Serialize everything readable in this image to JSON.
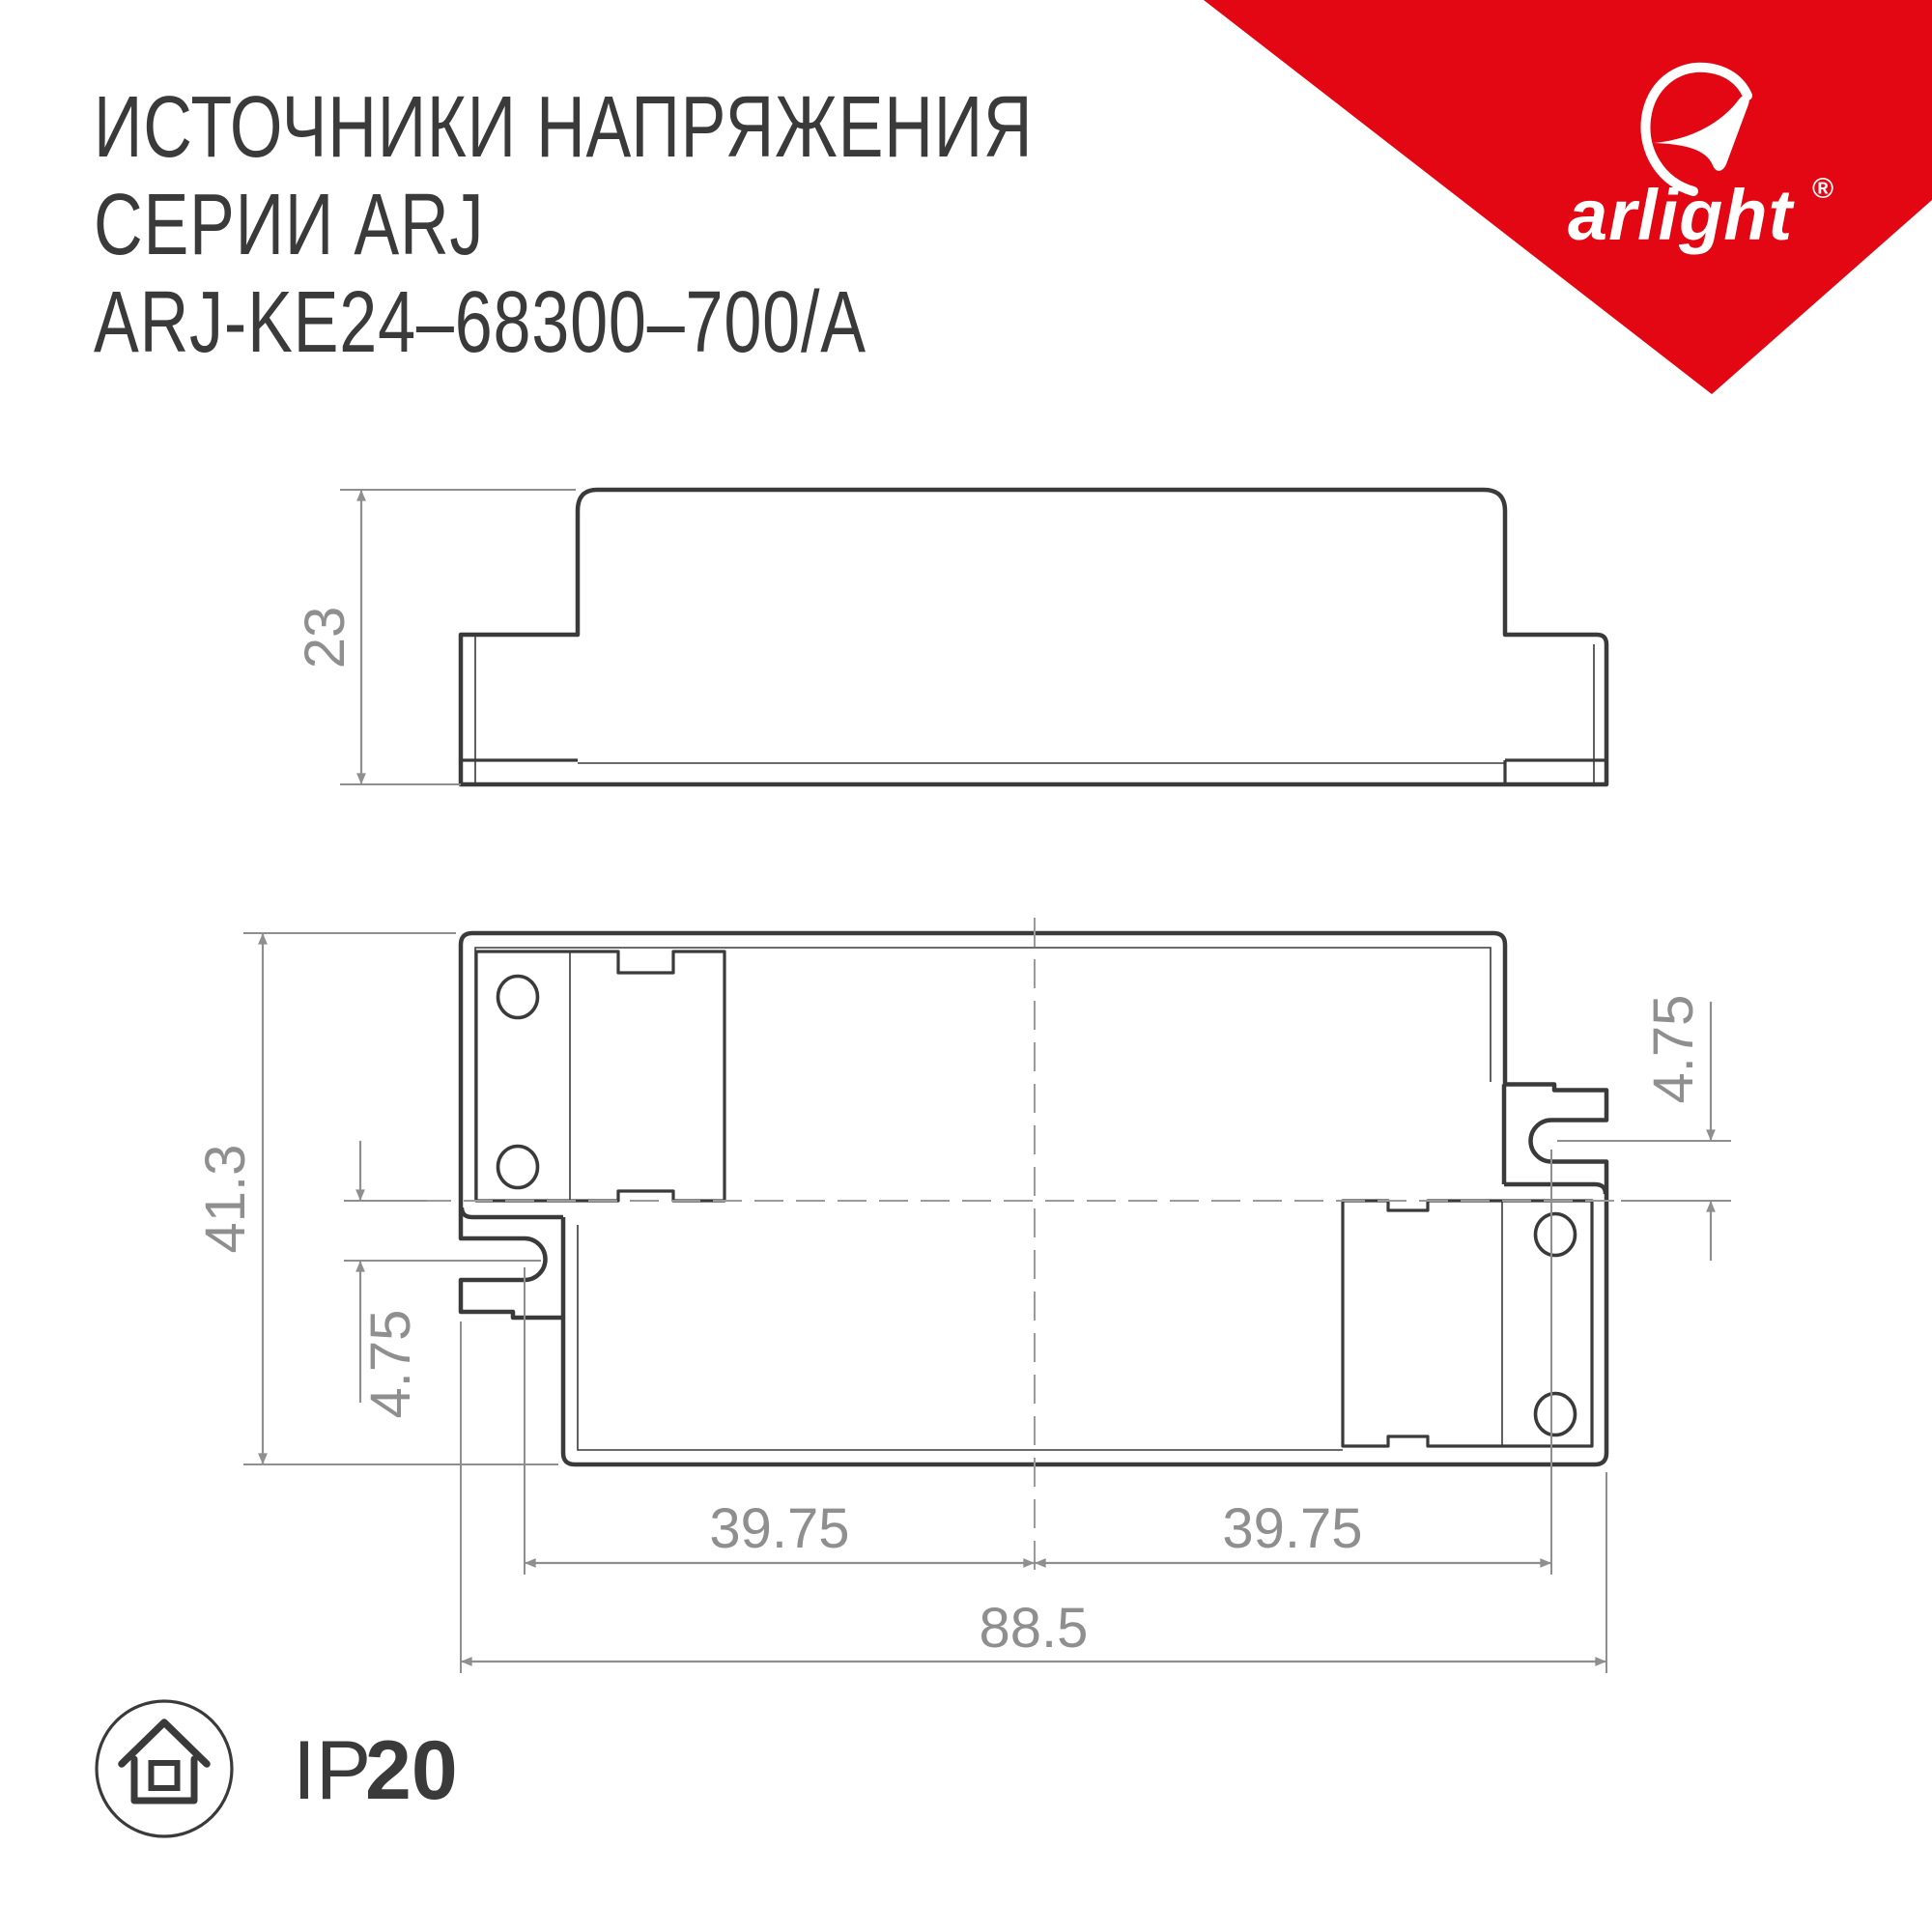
{
  "title": {
    "line1": "ИСТОЧНИКИ НАПРЯЖЕНИЯ",
    "line2": "СЕРИИ ARJ",
    "line3": "ARJ-KE24–68300–700/A"
  },
  "brand": {
    "wordmark": "arlight",
    "registered": "®",
    "triangle_color": "#e30613"
  },
  "drawing": {
    "views": {
      "side_view": "side profile of enclosure",
      "top_view": "plan view of enclosure with mounting tabs"
    },
    "dimensions": {
      "side_height": "23",
      "top_height": "41.3",
      "slot_offset_left": "4.75",
      "slot_offset_right": "4.75",
      "hole_span_left": "39.75",
      "hole_span_right": "39.75",
      "total_width": "88.5"
    },
    "colors": {
      "outline": "#3a3a3a",
      "dimension": "#8f8f8f"
    }
  },
  "footer": {
    "ip_prefix": "IP",
    "ip_value": "20"
  }
}
